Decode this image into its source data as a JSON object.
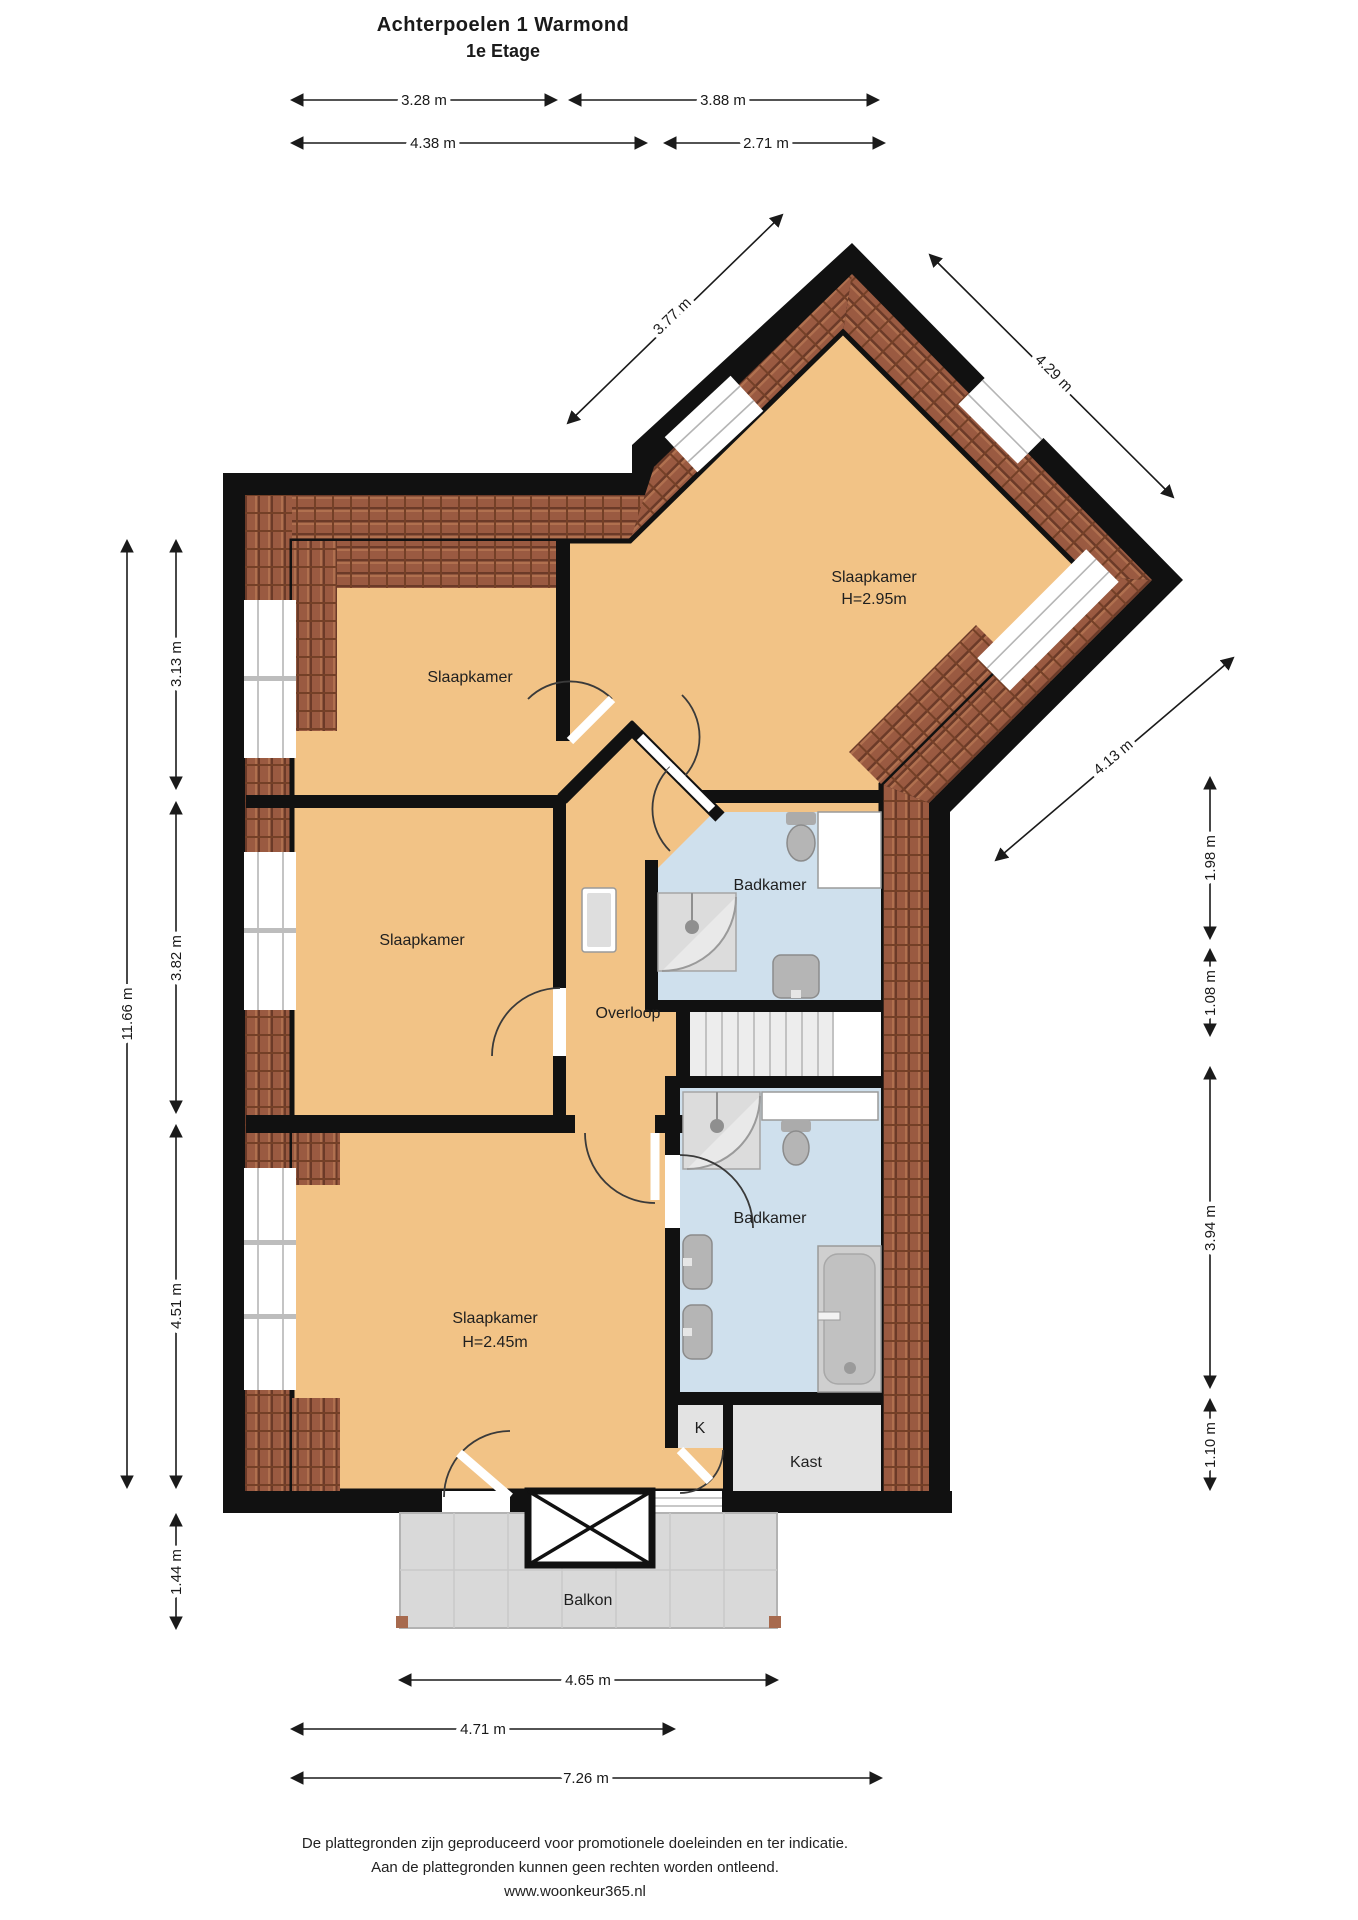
{
  "title": {
    "line1": "Achterpoelen 1  Warmond",
    "line2": "1e Etage"
  },
  "rooms": {
    "bedroom_top_left": "Slaapkamer",
    "bedroom_top_right": "Slaapkamer",
    "bedroom_top_right_height": "H=2.95m",
    "bedroom_mid_left": "Slaapkamer",
    "bedroom_bottom": "Slaapkamer",
    "bedroom_bottom_height": "H=2.45m",
    "hall": "Overloop",
    "bath_mid": "Badkamer",
    "bath_bottom": "Badkamer",
    "closet_small": "K",
    "closet": "Kast",
    "balcony": "Balkon"
  },
  "dimensions": {
    "top_row1_left": "3.28 m",
    "top_row1_right": "3.88 m",
    "top_row2_left": "4.38 m",
    "top_row2_right": "2.71 m",
    "left_total": "11.66 m",
    "left_seg1": "3.13 m",
    "left_seg2": "3.82 m",
    "left_seg3": "4.51 m",
    "left_seg4": "1.44 m",
    "diag_nw": "3.77 m",
    "diag_ne": "4.29 m",
    "diag_se": "4.13 m",
    "right_seg1": "1.98 m",
    "right_seg2": "1.08 m",
    "right_seg3": "3.94 m",
    "right_seg4": "1.10 m",
    "bottom_row1": "4.65 m",
    "bottom_row2": "4.71 m",
    "bottom_row3": "7.26 m"
  },
  "footer": {
    "line1": "De plattegronden zijn geproduceerd voor promotionele doeleinden en ter indicatie.",
    "line2": "Aan de plattegronden kunnen geen rechten worden ontleend.",
    "line3": "www.woonkeur365.nl"
  },
  "colors": {
    "floor": "#f2c386",
    "bathroom": "#cfe0ed",
    "roof_tile": "#9a5a41",
    "roof_tile_dark": "#6b3a28",
    "wall": "#111111",
    "balcony": "#d9d9d9",
    "closet_fill": "#e3e3e3"
  }
}
